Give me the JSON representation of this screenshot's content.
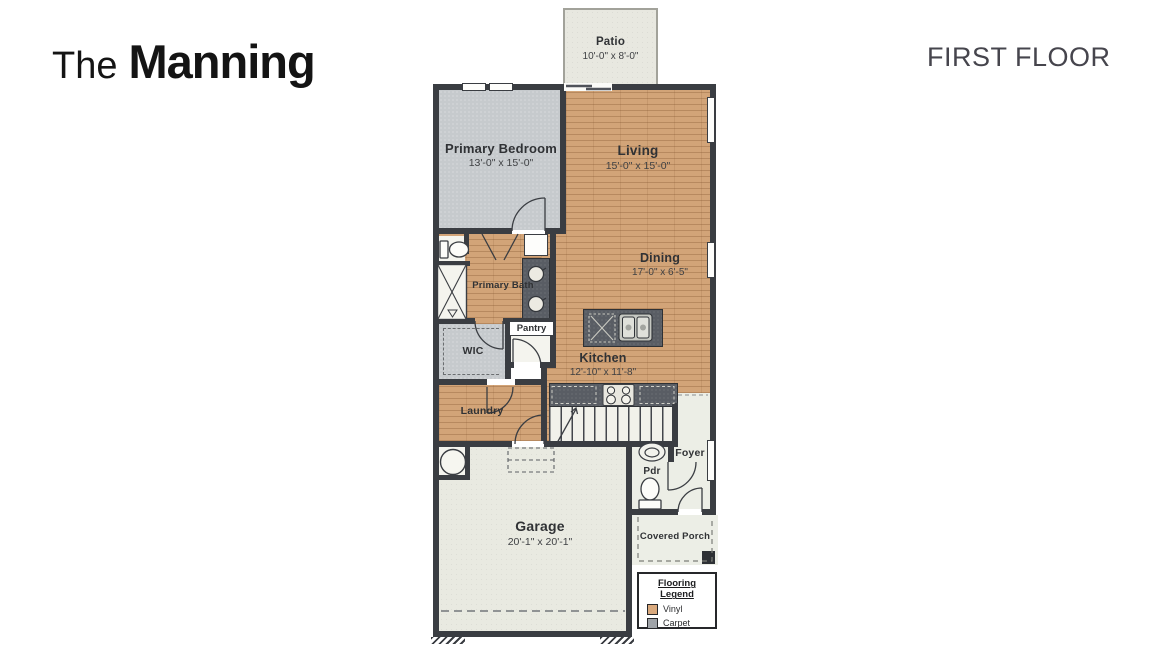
{
  "header": {
    "brand_prefix": "The",
    "brand_name": "Manning",
    "floor_label": "FIRST FLOOR"
  },
  "rooms": {
    "patio": {
      "name": "Patio",
      "dims": "10'-0\" x 8'-0\""
    },
    "primary_bedroom": {
      "name": "Primary Bedroom",
      "dims": "13'-0\" x 15'-0\""
    },
    "living": {
      "name": "Living",
      "dims": "15'-0\" x 15'-0\""
    },
    "dining": {
      "name": "Dining",
      "dims": "17'-0\" x 6'-5\""
    },
    "kitchen": {
      "name": "Kitchen",
      "dims": "12'-10\" x 11'-8\""
    },
    "primary_bath": {
      "name": "Primary Bath"
    },
    "wic": {
      "name": "WIC"
    },
    "pantry": {
      "name": "Pantry"
    },
    "laundry": {
      "name": "Laundry"
    },
    "foyer": {
      "name": "Foyer"
    },
    "pdr": {
      "name": "Pdr"
    },
    "garage": {
      "name": "Garage",
      "dims": "20'-1\" x 20'-1\""
    },
    "covered_porch": {
      "name": "Covered Porch"
    }
  },
  "legend": {
    "title": "Flooring Legend",
    "items": [
      {
        "label": "Vinyl",
        "color": "#d9a97d"
      },
      {
        "label": "Carpet",
        "color": "#9fa3a8"
      }
    ]
  },
  "colors": {
    "vinyl_floor": "#d2a478",
    "carpet_floor": "#c6cacd",
    "wall": "#3a3d42",
    "concrete": "#e9eae1",
    "counter": "#595d64"
  }
}
